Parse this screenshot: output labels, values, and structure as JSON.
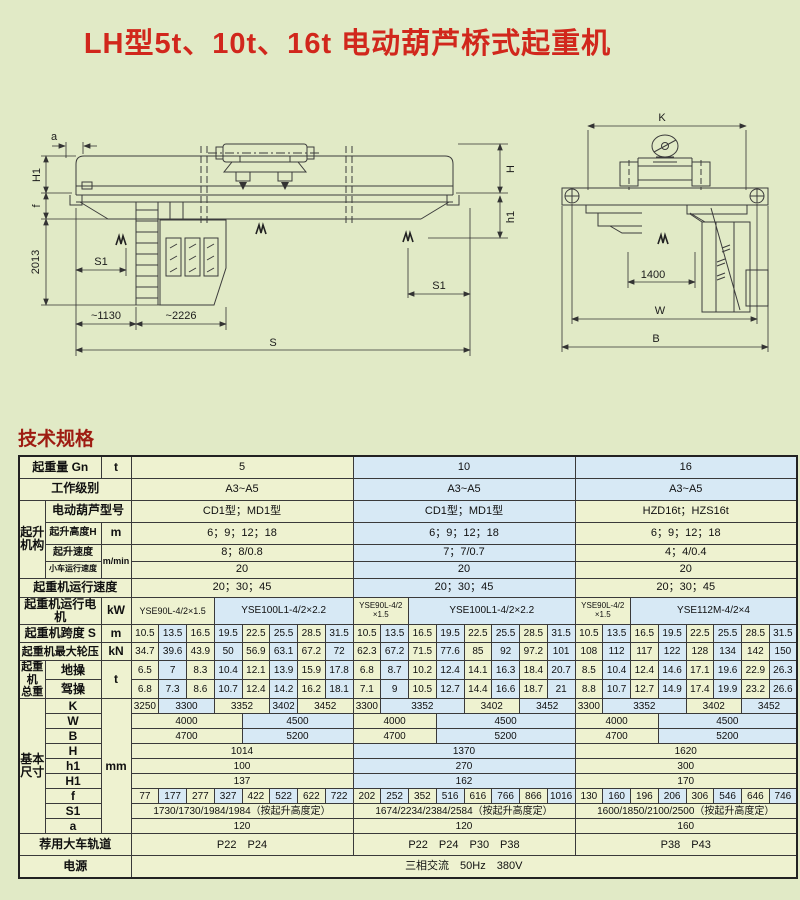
{
  "page": {
    "title": "LH型5t、10t、16t 电动葫芦桥式起重机",
    "section_heading": "技术规格"
  },
  "colors": {
    "page_bg": "#e1eac6",
    "title_red": "#d1271c",
    "heading_red": "#9e1c12",
    "cell_yellow": "#eef2d0",
    "cell_blue": "#d7e9f5",
    "border_dark": "#3a3a3a",
    "drawing_line": "#3c3c3c"
  },
  "drawings": {
    "side": {
      "a": "a",
      "H1": "H1",
      "f": "f",
      "d2013": "2013",
      "S1_left": "S1",
      "d1130": "~1130",
      "d2226": "~2226",
      "S": "S",
      "H": "H",
      "h1": "h1",
      "S1_right": "S1"
    },
    "end": {
      "K": "K",
      "d1400": "1400",
      "W": "W",
      "B": "B"
    }
  },
  "table": {
    "capacity_groups": [
      "5",
      "10",
      "16"
    ],
    "rows": [
      {
        "h": 22,
        "labels": [
          {
            "t": "起重量 Gn",
            "cs": 2
          },
          {
            "t": "t",
            "cs": 1
          }
        ],
        "cells": [
          {
            "t": "5",
            "s": 8,
            "c": "y"
          },
          {
            "t": "10",
            "s": 8,
            "c": "b"
          },
          {
            "t": "16",
            "s": 8,
            "c": "b"
          }
        ]
      },
      {
        "h": 22,
        "labels": [
          {
            "t": "工作级别",
            "cs": 3
          }
        ],
        "cells": [
          {
            "t": "A3~A5",
            "s": 8,
            "c": "y"
          },
          {
            "t": "A3~A5",
            "s": 8,
            "c": "b"
          },
          {
            "t": "A3~A5",
            "s": 8,
            "c": "b"
          }
        ]
      },
      {
        "h": 22,
        "labels": [
          {
            "t": "起升\n机构",
            "cs": 1,
            "rs": 4
          },
          {
            "t": "电动葫芦型号",
            "cs": 2
          }
        ],
        "cells": [
          {
            "t": "CD1型；MD1型",
            "s": 8,
            "c": "y"
          },
          {
            "t": "CD1型；MD1型",
            "s": 8,
            "c": "b"
          },
          {
            "t": "HZD16t；HZS16t",
            "s": 8,
            "c": "y"
          }
        ]
      },
      {
        "h": 22,
        "labels": [
          {
            "t": "起升高度H",
            "cs": 1,
            "fs": 10
          },
          {
            "t": "m",
            "cs": 1
          }
        ],
        "cells": [
          {
            "t": "6；9；12；18",
            "s": 8,
            "c": "y"
          },
          {
            "t": "6；9；12；18",
            "s": 8,
            "c": "b"
          },
          {
            "t": "6；9；12；18",
            "s": 8,
            "c": "y"
          }
        ]
      },
      {
        "h": 17,
        "labels": [
          {
            "t": "起升速度",
            "cs": 1,
            "fs": 10
          },
          {
            "t": "m/min",
            "cs": 1,
            "rs": 2,
            "fs": 9
          }
        ],
        "cells": [
          {
            "t": "8；8/0.8",
            "s": 8,
            "c": "y"
          },
          {
            "t": "7；7/0.7",
            "s": 8,
            "c": "b"
          },
          {
            "t": "4；4/0.4",
            "s": 8,
            "c": "y"
          }
        ]
      },
      {
        "h": 17,
        "labels": [
          {
            "t": "小车运行速度",
            "cs": 1,
            "fs": 8
          }
        ],
        "cells": [
          {
            "t": "20",
            "s": 8,
            "c": "y"
          },
          {
            "t": "20",
            "s": 8,
            "c": "b"
          },
          {
            "t": "20",
            "s": 8,
            "c": "y"
          }
        ]
      },
      {
        "h": 19,
        "labels": [
          {
            "t": "起重机运行速度",
            "cs": 3
          }
        ],
        "cells": [
          {
            "t": "20；30；45",
            "s": 8,
            "c": "y"
          },
          {
            "t": "20；30；45",
            "s": 8,
            "c": "b"
          },
          {
            "t": "20；30；45",
            "s": 8,
            "c": "y"
          }
        ]
      },
      {
        "h": 20,
        "labels": [
          {
            "t": "起重机运行电机",
            "cs": 2
          },
          {
            "t": "kW",
            "cs": 1
          }
        ],
        "cells": [
          {
            "t": "YSE90L-4/2×1.5",
            "s": 3,
            "c": "y",
            "fs": 9
          },
          {
            "t": "YSE100L1-4/2×2.2",
            "s": 5,
            "c": "b",
            "fs": 10
          },
          {
            "t": "YSE90L-4/2\n×1.5",
            "s": 2,
            "c": "y",
            "fs": 8
          },
          {
            "t": "YSE100L1-4/2×2.2",
            "s": 6,
            "c": "b",
            "fs": 10
          },
          {
            "t": "YSE90L-4/2\n×1.5",
            "s": 2,
            "c": "y",
            "fs": 8
          },
          {
            "t": "YSE112M-4/2×4",
            "s": 6,
            "c": "b",
            "fs": 10
          }
        ]
      },
      {
        "h": 18,
        "labels": [
          {
            "t": "起重机跨度 S",
            "cs": 2
          },
          {
            "t": "m",
            "cs": 1
          }
        ],
        "vals": [
          "10.5",
          "13.5",
          "16.5",
          "19.5",
          "22.5",
          "25.5",
          "28.5",
          "31.5",
          "10.5",
          "13.5",
          "16.5",
          "19.5",
          "22.5",
          "25.5",
          "28.5",
          "31.5",
          "10.5",
          "13.5",
          "16.5",
          "19.5",
          "22.5",
          "25.5",
          "28.5",
          "31.5"
        ]
      },
      {
        "h": 18,
        "labels": [
          {
            "t": "起重机最大轮压",
            "cs": 2,
            "fs": 11
          },
          {
            "t": "kN",
            "cs": 1
          }
        ],
        "vals": [
          "34.7",
          "39.6",
          "43.9",
          "50",
          "56.9",
          "63.1",
          "67.2",
          "72",
          "62.3",
          "67.2",
          "71.5",
          "77.6",
          "85",
          "92",
          "97.2",
          "101",
          "108",
          "112",
          "117",
          "122",
          "128",
          "134",
          "142",
          "150"
        ]
      },
      {
        "h": 18,
        "labels": [
          {
            "t": "起重\n机\n总重",
            "cs": 1,
            "rs": 2,
            "fs": 11
          },
          {
            "t": "地操",
            "cs": 1
          },
          {
            "t": "t",
            "cs": 1,
            "rs": 2
          }
        ],
        "vals": [
          "6.5",
          "7",
          "8.3",
          "10.4",
          "12.1",
          "13.9",
          "15.9",
          "17.8",
          "6.8",
          "8.7",
          "10.2",
          "12.4",
          "14.1",
          "16.3",
          "18.4",
          "20.7",
          "8.5",
          "10.4",
          "12.4",
          "14.6",
          "17.1",
          "19.6",
          "22.9",
          "26.3"
        ]
      },
      {
        "h": 18,
        "labels": [
          {
            "t": "驾操",
            "cs": 1
          }
        ],
        "vals": [
          "6.8",
          "7.3",
          "8.6",
          "10.7",
          "12.4",
          "14.2",
          "16.2",
          "18.1",
          "7.1",
          "9",
          "10.5",
          "12.7",
          "14.4",
          "16.6",
          "18.7",
          "21",
          "8.8",
          "10.7",
          "12.7",
          "14.9",
          "17.4",
          "19.9",
          "23.2",
          "26.6"
        ]
      },
      {
        "h": 15,
        "labels": [
          {
            "t": "基本\n尺寸",
            "cs": 1,
            "rs": 9
          },
          {
            "t": "K",
            "cs": 1
          },
          {
            "t": "mm",
            "cs": 1,
            "rs": 9
          }
        ],
        "cells": [
          {
            "t": "3250",
            "s": 1,
            "c": "y",
            "fs": 10
          },
          {
            "t": "3300",
            "s": 2,
            "c": "b",
            "fs": 10
          },
          {
            "t": "3352",
            "s": 2,
            "c": "y",
            "fs": 10
          },
          {
            "t": "3402",
            "s": 1,
            "c": "b",
            "fs": 10
          },
          {
            "t": "3452",
            "s": 2,
            "c": "y",
            "fs": 10
          },
          {
            "t": "3300",
            "s": 1,
            "c": "y",
            "fs": 10
          },
          {
            "t": "3352",
            "s": 3,
            "c": "b",
            "fs": 10
          },
          {
            "t": "3402",
            "s": 2,
            "c": "y",
            "fs": 10
          },
          {
            "t": "3452",
            "s": 2,
            "c": "b",
            "fs": 10
          },
          {
            "t": "3300",
            "s": 1,
            "c": "y",
            "fs": 10
          },
          {
            "t": "3352",
            "s": 3,
            "c": "b",
            "fs": 10
          },
          {
            "t": "3402",
            "s": 2,
            "c": "y",
            "fs": 10
          },
          {
            "t": "3452",
            "s": 2,
            "c": "b",
            "fs": 10
          }
        ]
      },
      {
        "h": 15,
        "labels": [
          {
            "t": "W",
            "cs": 1
          }
        ],
        "cells": [
          {
            "t": "4000",
            "s": 4,
            "c": "y",
            "fs": 10
          },
          {
            "t": "4500",
            "s": 4,
            "c": "b",
            "fs": 10
          },
          {
            "t": "4000",
            "s": 3,
            "c": "y",
            "fs": 10
          },
          {
            "t": "4500",
            "s": 5,
            "c": "b",
            "fs": 10
          },
          {
            "t": "4000",
            "s": 3,
            "c": "y",
            "fs": 10
          },
          {
            "t": "4500",
            "s": 5,
            "c": "b",
            "fs": 10
          }
        ]
      },
      {
        "h": 15,
        "labels": [
          {
            "t": "B",
            "cs": 1
          }
        ],
        "cells": [
          {
            "t": "4700",
            "s": 4,
            "c": "y",
            "fs": 10
          },
          {
            "t": "5200",
            "s": 4,
            "c": "b",
            "fs": 10
          },
          {
            "t": "4700",
            "s": 3,
            "c": "y",
            "fs": 10
          },
          {
            "t": "5200",
            "s": 5,
            "c": "b",
            "fs": 10
          },
          {
            "t": "4700",
            "s": 3,
            "c": "y",
            "fs": 10
          },
          {
            "t": "5200",
            "s": 5,
            "c": "b",
            "fs": 10
          }
        ]
      },
      {
        "h": 15,
        "labels": [
          {
            "t": "H",
            "cs": 1
          }
        ],
        "cells": [
          {
            "t": "1014",
            "s": 8,
            "c": "y",
            "fs": 10
          },
          {
            "t": "1370",
            "s": 8,
            "c": "b",
            "fs": 10
          },
          {
            "t": "1620",
            "s": 8,
            "c": "y",
            "fs": 10
          }
        ]
      },
      {
        "h": 15,
        "labels": [
          {
            "t": "h1",
            "cs": 1
          }
        ],
        "cells": [
          {
            "t": "100",
            "s": 8,
            "c": "y",
            "fs": 10
          },
          {
            "t": "270",
            "s": 8,
            "c": "b",
            "fs": 10
          },
          {
            "t": "300",
            "s": 8,
            "c": "y",
            "fs": 10
          }
        ]
      },
      {
        "h": 15,
        "labels": [
          {
            "t": "H1",
            "cs": 1
          }
        ],
        "cells": [
          {
            "t": "137",
            "s": 8,
            "c": "y",
            "fs": 10
          },
          {
            "t": "162",
            "s": 8,
            "c": "b",
            "fs": 10
          },
          {
            "t": "170",
            "s": 8,
            "c": "y",
            "fs": 10
          }
        ]
      },
      {
        "h": 15,
        "labels": [
          {
            "t": "f",
            "cs": 1
          }
        ],
        "vals": [
          "77",
          "177",
          "277",
          "327",
          "422",
          "522",
          "622",
          "722",
          "202",
          "252",
          "352",
          "516",
          "616",
          "766",
          "866",
          "1016",
          "130",
          "160",
          "196",
          "206",
          "306",
          "546",
          "646",
          "746"
        ]
      },
      {
        "h": 15,
        "labels": [
          {
            "t": "S1",
            "cs": 1
          }
        ],
        "cells": [
          {
            "t": "1730/1730/1984/1984（按起升高度定）",
            "s": 8,
            "c": "y",
            "fs": 10
          },
          {
            "t": "1674/2234/2384/2584（按起升高度定）",
            "s": 8,
            "c": "y",
            "fs": 10
          },
          {
            "t": "1600/1850/2100/2500（按起升高度定）",
            "s": 8,
            "c": "y",
            "fs": 10
          }
        ]
      },
      {
        "h": 15,
        "labels": [
          {
            "t": "a",
            "cs": 1
          }
        ],
        "cells": [
          {
            "t": "120",
            "s": 8,
            "c": "y",
            "fs": 10
          },
          {
            "t": "120",
            "s": 8,
            "c": "y",
            "fs": 10
          },
          {
            "t": "160",
            "s": 8,
            "c": "y",
            "fs": 10
          }
        ]
      },
      {
        "h": 22,
        "labels": [
          {
            "t": "荐用大车轨道",
            "cs": 3
          }
        ],
        "cells": [
          {
            "t": "P22　P24",
            "s": 8,
            "c": "y"
          },
          {
            "t": "P22　P24　P30　P38",
            "s": 8,
            "c": "y"
          },
          {
            "t": "P38　P43",
            "s": 8,
            "c": "y"
          }
        ]
      },
      {
        "h": 22,
        "labels": [
          {
            "t": "电源",
            "cs": 3
          }
        ],
        "cells": [
          {
            "t": "三相交流　50Hz　380V",
            "s": 24,
            "c": "y"
          }
        ]
      }
    ]
  }
}
